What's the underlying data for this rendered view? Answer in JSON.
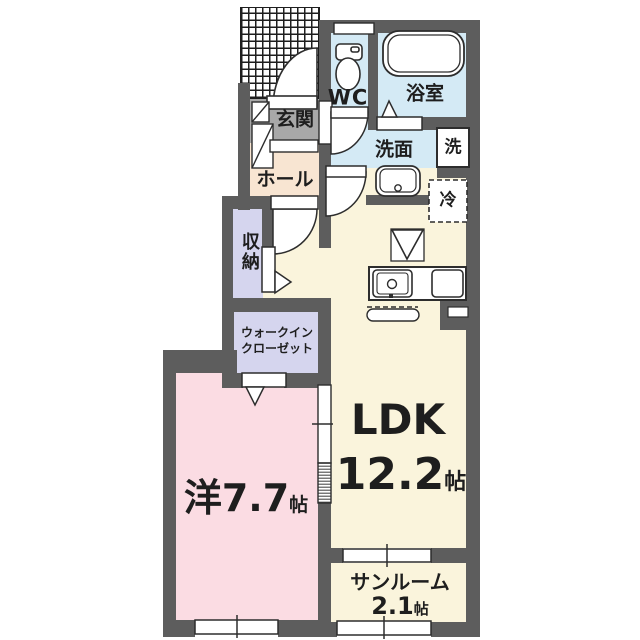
{
  "plan_title": "apartment-floor-plan",
  "rooms": {
    "genkan": {
      "label": "玄関"
    },
    "hall": {
      "label": "ホール"
    },
    "wc": {
      "label": "WC"
    },
    "bath": {
      "label": "浴室"
    },
    "washroom": {
      "label": "洗面"
    },
    "washer": {
      "label": "洗"
    },
    "fridge": {
      "label": "冷"
    },
    "storage": {
      "label": "収納"
    },
    "wic": {
      "label_line1": "ウォークイン",
      "label_line2": "クローゼット"
    },
    "ldk": {
      "label": "LDK",
      "size_value": "12.2",
      "size_unit": "帖"
    },
    "western": {
      "size_value": "洋7.7",
      "size_unit": "帖"
    },
    "sunroom": {
      "label": "サンルーム",
      "size_value": "2.1",
      "size_unit": "帖"
    }
  },
  "palette": {
    "wall_gray": "#5d5d5d",
    "water_area_blue": "#d4eaf5",
    "ldk_cream": "#faf4dc",
    "bedroom_pink": "#fbdce3",
    "closet_lavender": "#d5d5ee",
    "hall_peach": "#f8e5d2",
    "genkan_gray": "#a8a8a8",
    "line_dark": "#2d2d2d",
    "text_dark": "#1e1e1e"
  }
}
